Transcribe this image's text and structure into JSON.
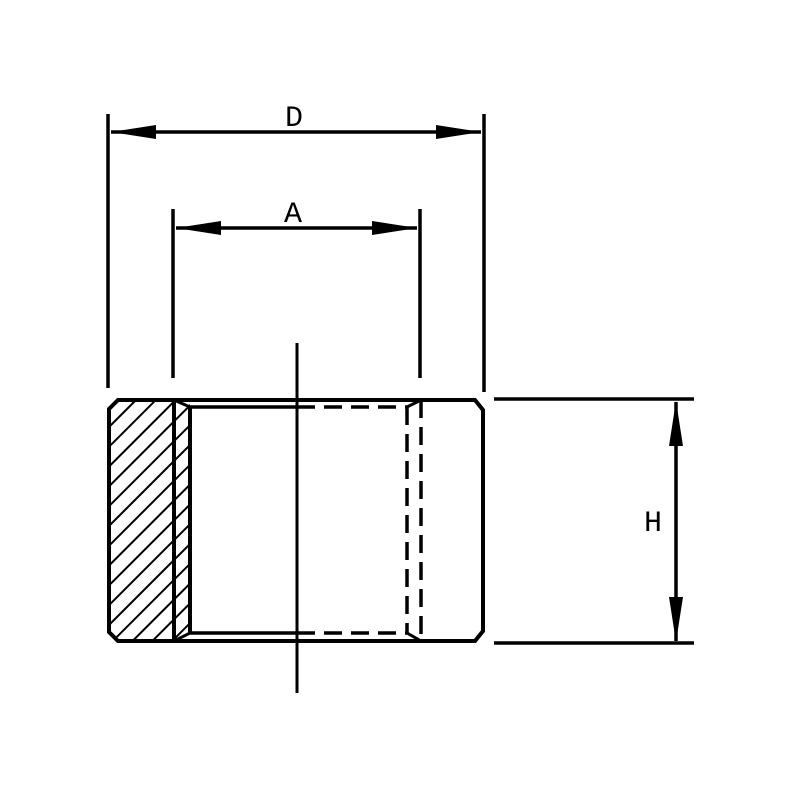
{
  "drawing": {
    "description": "Sectioned technical drawing of an internally threaded cylindrical fitting (coupling) with dimension callouts",
    "background_color": "#ffffff",
    "stroke_color": "#000000"
  },
  "dimension_labels": {
    "outer_diameter": "D",
    "thread_diameter": "A",
    "height": "H"
  }
}
